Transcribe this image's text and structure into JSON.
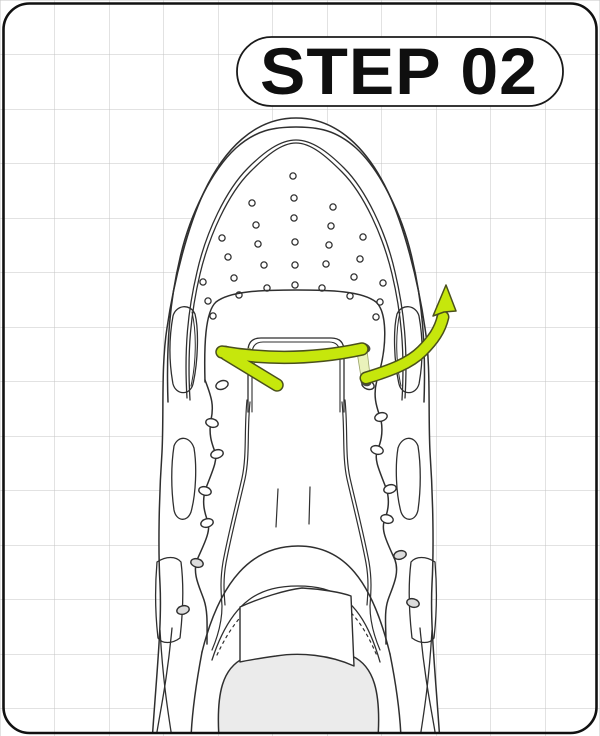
{
  "step_badge": {
    "label": "STEP 02"
  },
  "illustration": {
    "icons": [
      "up-arrow-icon"
    ],
    "subject_note": "top view sneaker with lace threaded straight across bottom eyelets, right end pulled outward and upward"
  },
  "colors": {
    "background": "#ffffff",
    "grid_line": "#c4c4c4",
    "frame_border": "#111111",
    "line": "#2f2f2f",
    "lace": "#c6e70c",
    "lace_pale": "#eaf2bb",
    "lace_outline": "#4a501c",
    "eyelet_dark": "#4a4a4a",
    "footbed": "#ebebeb",
    "badge_fill": "#ffffff",
    "badge_border": "#1a1a1a",
    "badge_text": "#0f0f0f"
  }
}
